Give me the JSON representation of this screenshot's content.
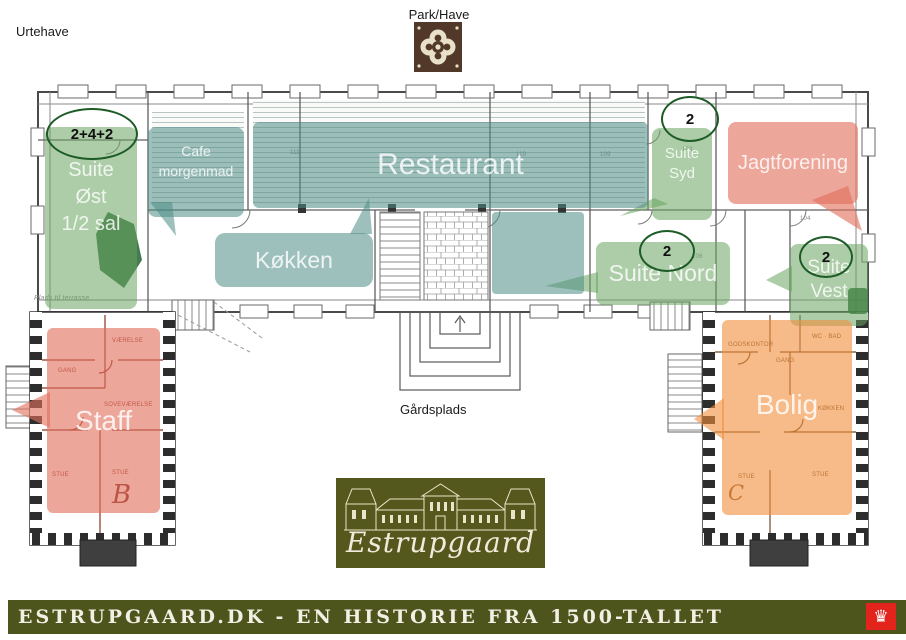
{
  "titles": {
    "urtehave": "Urtehave",
    "park_have": "Park/Have",
    "gaardsplads": "Gårdsplads"
  },
  "colors": {
    "green-fill": "rgba(104,164,94,0.55)",
    "green-dark": "rgba(28,94,40,0.82)",
    "teal-fill": "rgba(77,140,133,0.55)",
    "salmon-fill": "rgba(226,112,92,0.62)",
    "orange-fill": "rgba(242,142,58,0.60)",
    "ellipse-stroke": "#1d5c26",
    "olive": "#4d551d",
    "logo-olive": "#54581d",
    "cream": "#efeada",
    "brown": "#523829",
    "crown-red": "#e2241d"
  },
  "overlays": {
    "suite_ost": {
      "lines": [
        "Suite",
        "Øst",
        "1/2 sal"
      ]
    },
    "cafe": {
      "lines": [
        "Cafe",
        "morgenmad"
      ]
    },
    "restaurant": {
      "label": "Restaurant"
    },
    "kokken": {
      "label": "Køkken"
    },
    "suite_syd": {
      "lines": [
        "Suite",
        "Syd"
      ]
    },
    "jagtforening": {
      "label": "Jagtforening"
    },
    "suite_nord": {
      "label": "Suite Nord"
    },
    "suite_vest": {
      "lines": [
        "Suite",
        "Vest"
      ]
    },
    "staff": {
      "label": "Staff"
    },
    "bolig": {
      "label": "Bolig"
    }
  },
  "badges": {
    "suite_ost": "2+4+2",
    "suite_syd": "2",
    "suite_nord": "2",
    "suite_vest": "2"
  },
  "plan": {
    "wing_b": "B",
    "wing_c": "C",
    "rooms": [
      {
        "n": "111"
      },
      {
        "n": "110"
      },
      {
        "n": "109"
      },
      {
        "n": "103"
      },
      {
        "n": "104"
      },
      {
        "n": "106"
      }
    ],
    "notes": [
      {
        "t": "Plads til terrasse"
      },
      {
        "t": "GANG"
      },
      {
        "t": "VÆRELSE"
      },
      {
        "t": "SOVEVÆRELSE"
      },
      {
        "t": "STUE"
      },
      {
        "t": "STUE"
      },
      {
        "t": "GODSKONTOR"
      },
      {
        "t": "GANG"
      },
      {
        "t": "WC · BAD"
      },
      {
        "t": "KØKKEN"
      },
      {
        "t": "STUE"
      },
      {
        "t": "STUE"
      }
    ]
  },
  "logo": {
    "name": "Estrupgaard"
  },
  "footer": {
    "text": "ESTRUPGAARD.DK - EN HISTORIE FRA 1500-TALLET"
  }
}
